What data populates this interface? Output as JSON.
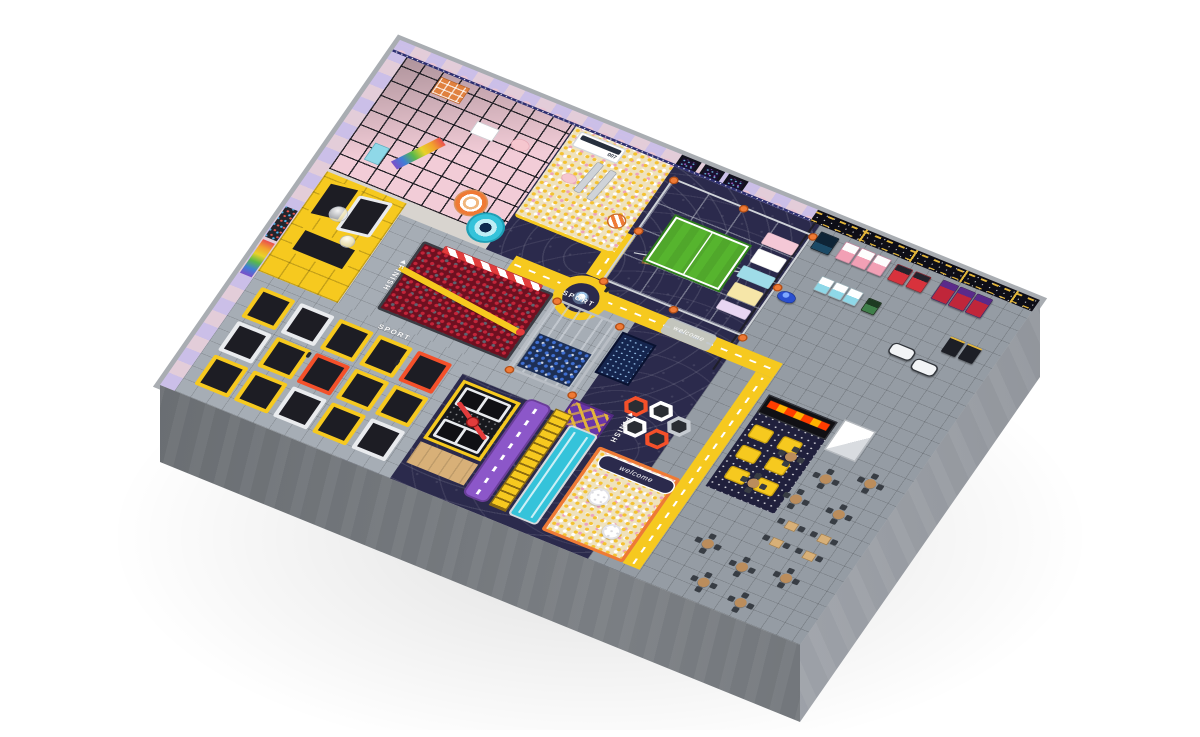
{
  "palette": {
    "page_bg": "#ffffff",
    "concrete_rim": "#a9adb2",
    "cl1": "#63676b",
    "cl2": "#7a7e83",
    "cr1": "#8a8e94",
    "cr2": "#9da1a8",
    "wall_lavender": "#b7aede",
    "wall_pink": "#eac4d3",
    "wall_navy": "#2d2f70",
    "star_black": "#0d0d16",
    "gold": "#e2b53a",
    "floor_navy": "#2b2a4c",
    "road_yellow": "#f6c91f",
    "tile_light": "#a6adb5",
    "tile_mid": "#959ca4",
    "frame_black": "#1d1d24",
    "soft_pink": "#f2ccd7",
    "pit_cream": "#efe2bd",
    "ball_yellow": "#f4c231",
    "ball_pink": "#eda4bb",
    "pit_red": "#6e1020",
    "ball_red": "#c32439",
    "ball_gray": "#5c6370",
    "pit_blue": "#1d2f55",
    "ball_blue": "#3f6fd2",
    "field_green": "#56b42e",
    "orange": "#ef7a35",
    "orange_bright": "#f4502a",
    "cyan": "#35c3da",
    "slide_purple": "#8c57c9",
    "maze_purple": "#6a35a8",
    "led_blue": "#15254e",
    "wood": "#d8b078",
    "table_top": "#bb8d5c",
    "chair_dark": "#383d44",
    "lava_a": "#ff3d00",
    "lava_b": "#ffb300"
  },
  "floor_markings": {
    "sport": "SPORT",
    "finish": "FINISH",
    "welcome": "welcome"
  },
  "signs": {
    "bus_number": "007"
  }
}
